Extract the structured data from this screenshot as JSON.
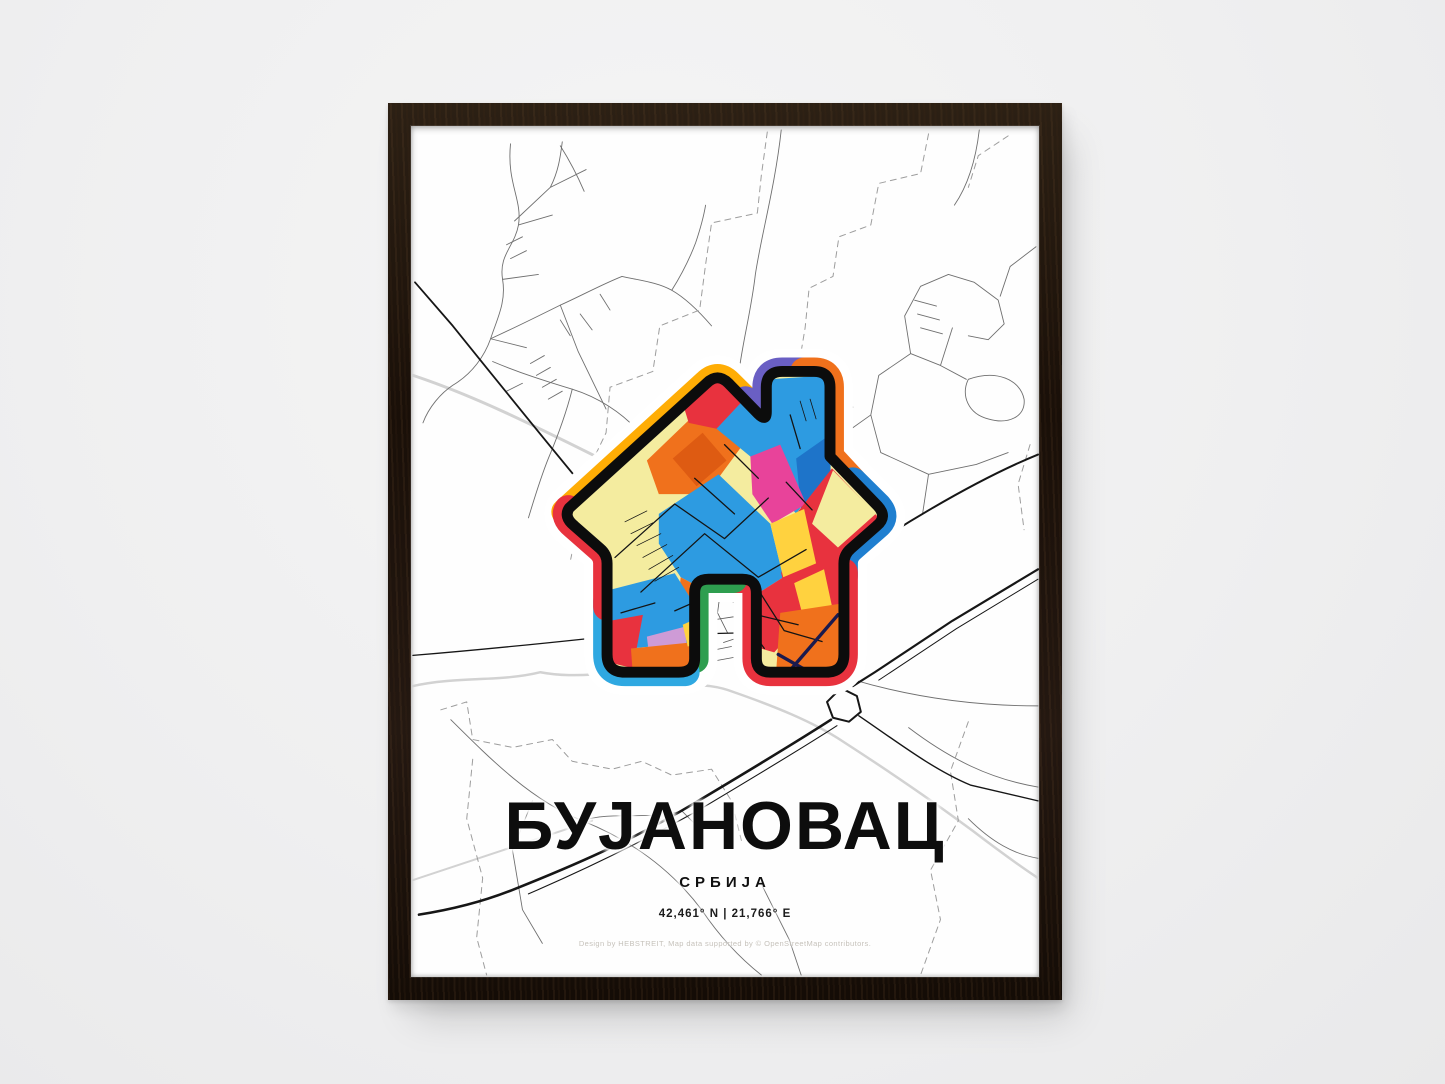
{
  "wall": {
    "color": "#efeff0"
  },
  "frame": {
    "wood_color": "#1f150d"
  },
  "poster": {
    "title": "БУЈАНОВАЦ",
    "subtitle": "СРБИЈА",
    "coordinates": "42,461° N | 21,766° E",
    "credit": "Design by HEBSTREIT, Map data supported by © OpenStreetMap contributors.",
    "palette": {
      "amber": "#FFAD05",
      "purple": "#6A5FC4",
      "orange": "#F0711C",
      "dark_orange": "#DE5B12",
      "blue": "#2D9BE1",
      "dark_blue": "#1F7FD0",
      "mid_blue": "#1E74C9",
      "red": "#E8323E",
      "green": "#2E9E4F",
      "light_blue": "#2FA8E1",
      "magenta": "#E8439A",
      "yellow": "#FFD23F",
      "pale_yellow": "#F4EC9F",
      "lavender": "#CE9BD6",
      "navy": "#1A1A4E"
    }
  }
}
